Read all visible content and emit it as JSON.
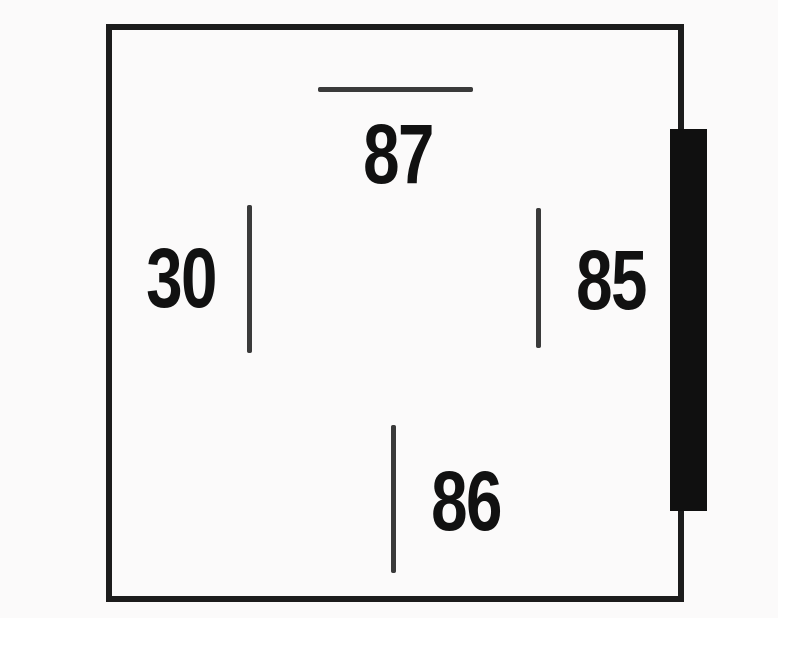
{
  "diagram": {
    "type": "relay-terminal-pinout",
    "pins": [
      {
        "id": "87",
        "label": "87",
        "side": "top",
        "mark": "horizontal-line"
      },
      {
        "id": "30",
        "label": "30",
        "side": "left",
        "mark": "vertical-line"
      },
      {
        "id": "85",
        "label": "85",
        "side": "right",
        "mark": "vertical-line"
      },
      {
        "id": "86",
        "label": "86",
        "side": "bottom",
        "mark": "vertical-line"
      }
    ],
    "colors": {
      "outline": "#1c1c1c",
      "pin-line": "#3a3a3a",
      "label-text": "#111111",
      "bracket": "#101010",
      "scan-bg": "#fbfafa",
      "canvas": "#ffffff"
    }
  }
}
